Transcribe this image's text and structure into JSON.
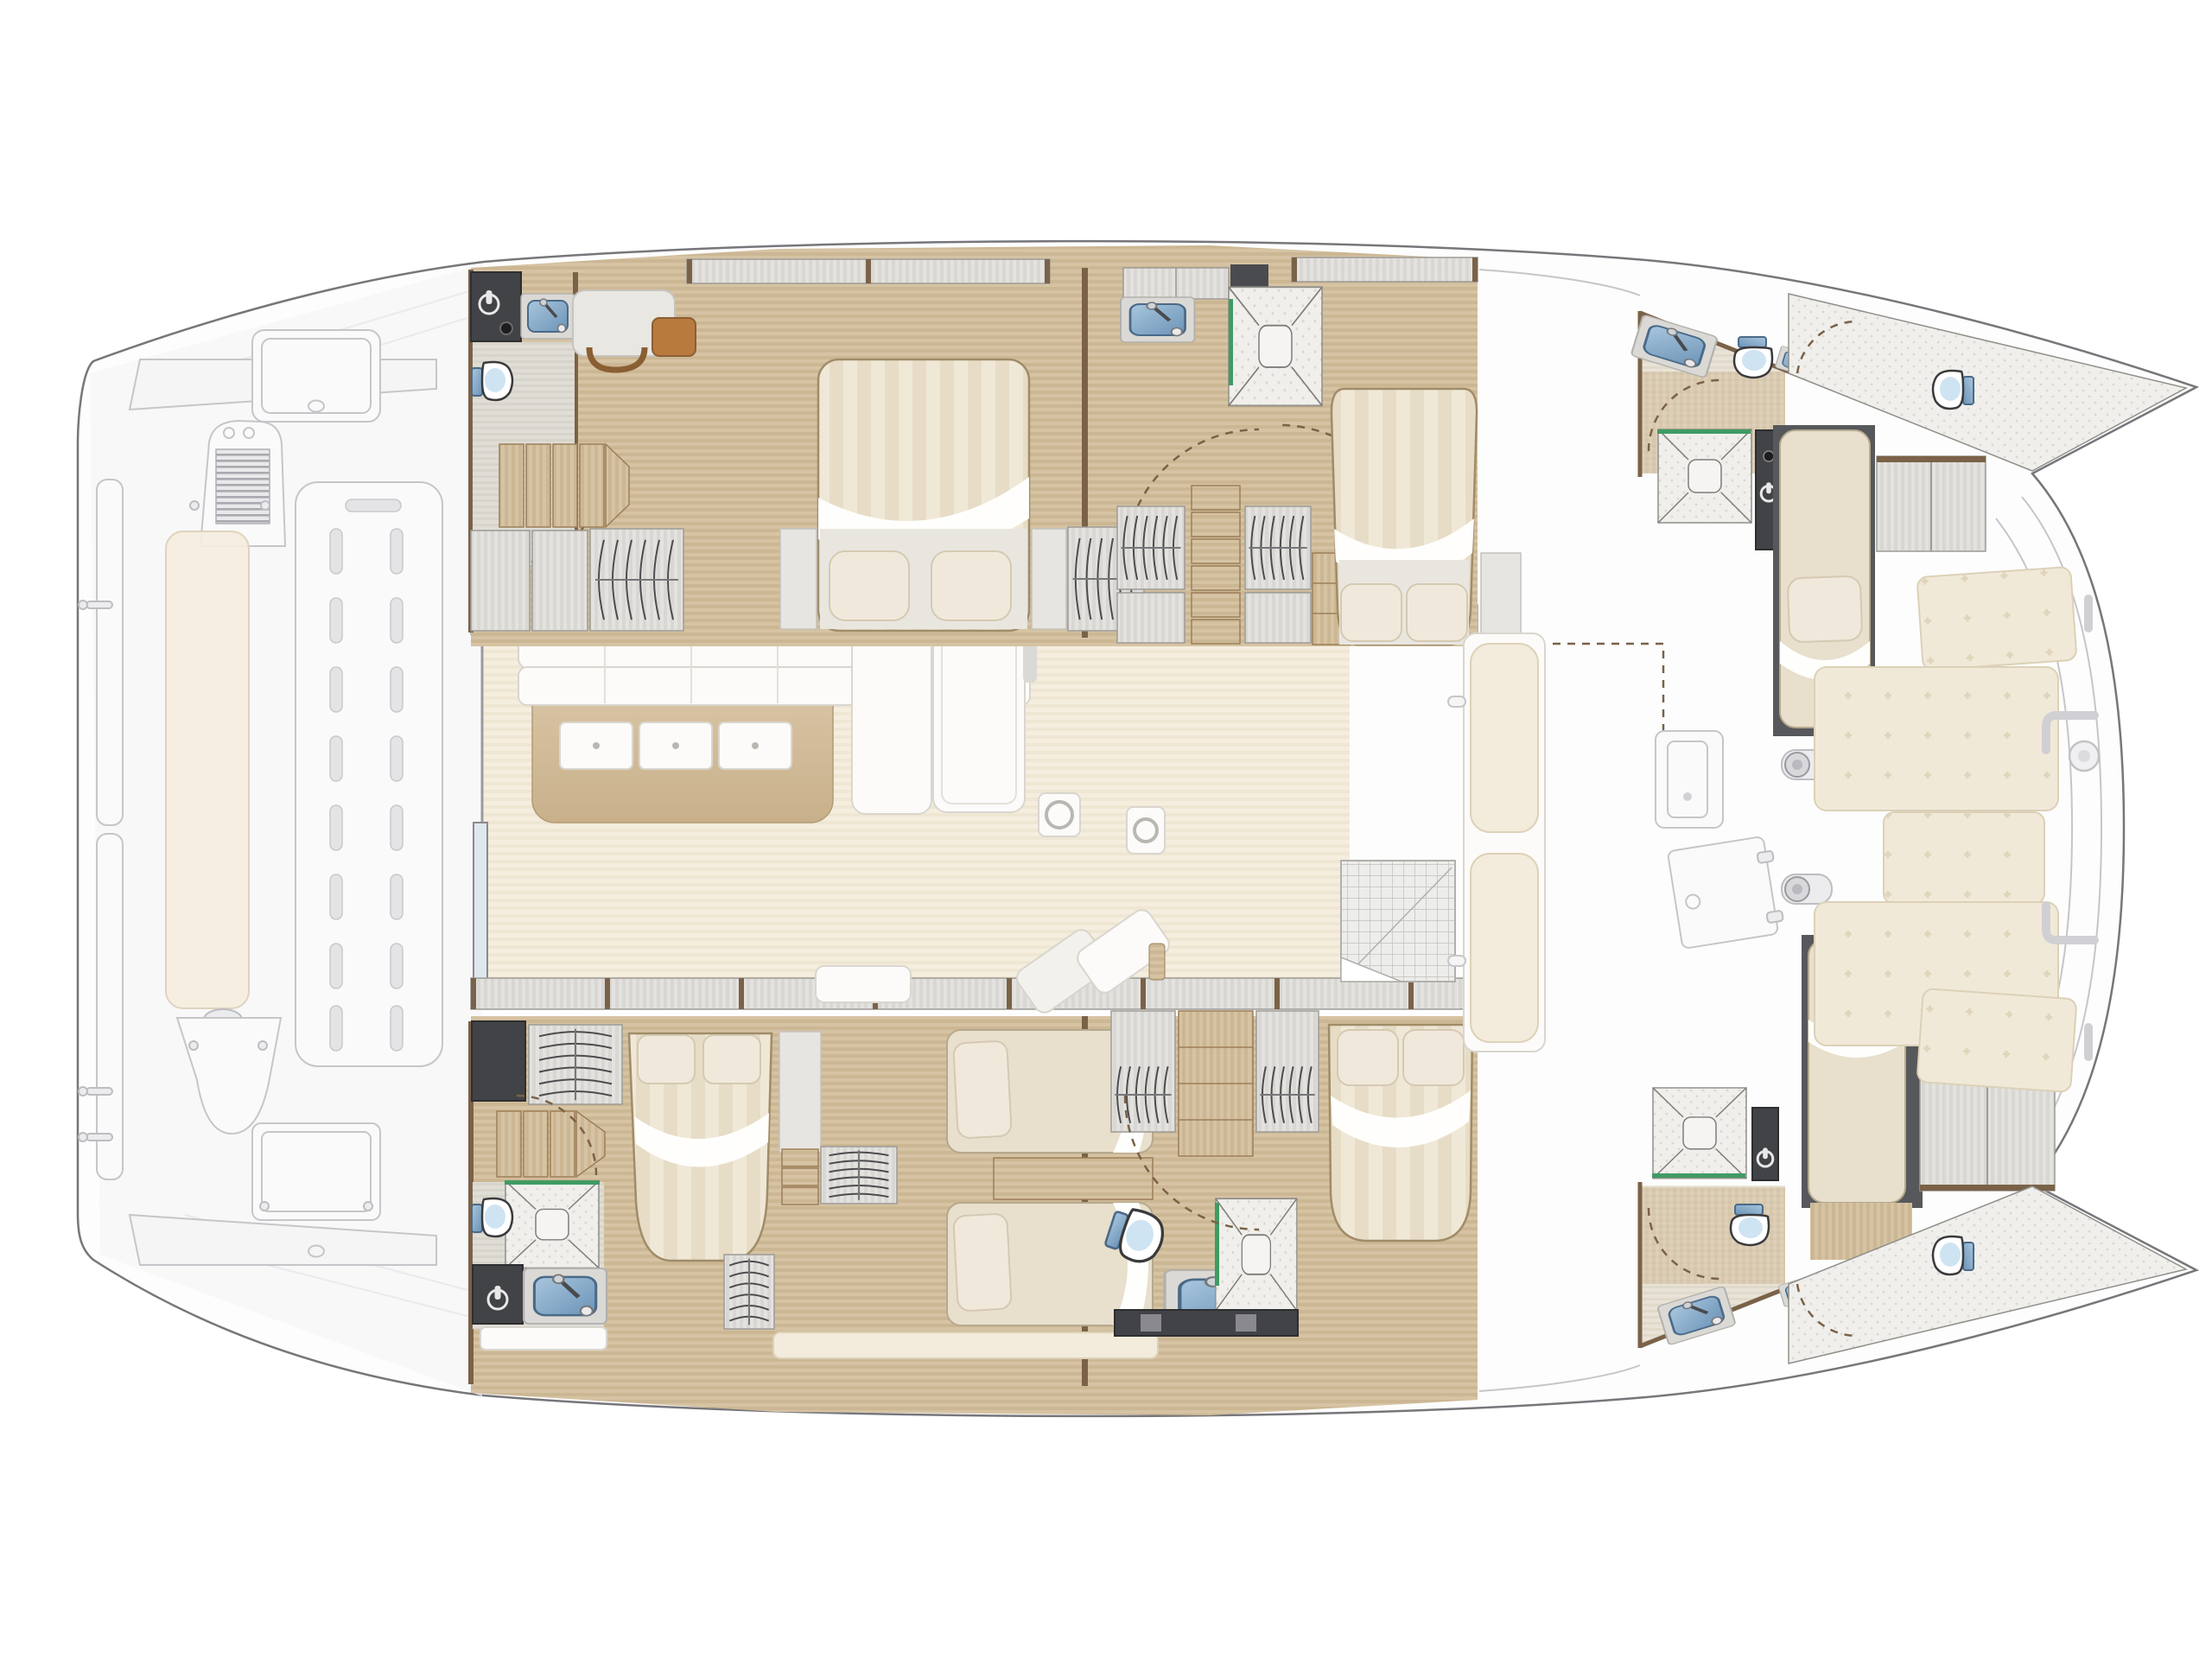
{
  "vessel": {
    "type": "sailing-catamaran",
    "view": "interior-deck-plan-top-view",
    "orientation": {
      "bow": "right",
      "stern": "left"
    }
  },
  "palette": {
    "hull-line": "#76767b",
    "ghost-line": "#c6c6ca",
    "ghost-fill": "#f5f5f6",
    "wall": "#7a6248",
    "wood-a": "#d6c3a3",
    "wood-b": "#ccb794",
    "woodpale-a": "#f5eedf",
    "woodpale-b": "#efe6d3",
    "wgray-a": "#e3e2df",
    "wgray-b": "#d8d7d3",
    "mattress-a": "#e7dcc6",
    "mattress-b": "#f0e8d7",
    "cushion": "#f3ebdb",
    "locker": "#424346",
    "sink-a": "#a9c6de",
    "sink-b": "#6b93b6",
    "glass": "#3f9b63",
    "speckle": "#f0efec",
    "island-a": "#dcc8a9",
    "island-b": "#c8b08a"
  },
  "areas": {
    "aft_deck": [
      "transom-benches",
      "grill-console",
      "cockpit-bench",
      "lounge-panel",
      "deck-hatch-forward",
      "deck-hatch-aft",
      "cleats",
      "helm-seat"
    ],
    "salon": [
      "galley-island",
      "island-drawers-x3",
      "bench-sofa",
      "sofa-corner-arm",
      "dining-table",
      "deck-ring-hatch",
      "deck-ring-hatch-2",
      "small-bench",
      "chaise-lounge",
      "sliding-door",
      "entry-mat"
    ],
    "port_hull": {
      "aft_cabin": [
        "double-berth",
        "pillows-x2",
        "wardrobe",
        "desk",
        "chair",
        "steps",
        "head-wc",
        "head-basin",
        "wet-locker"
      ],
      "mid_cabin": [
        "double-berth",
        "pillows-x2",
        "wardrobes-x2",
        "steps",
        "basin",
        "shower"
      ],
      "fwd_cabin": [
        "single-berth",
        "pillow",
        "wardrobe",
        "shower",
        "wet-locker",
        "head-wc",
        "head-basin"
      ],
      "forepeak": [
        "wc"
      ]
    },
    "starboard_hull": {
      "aft_cabin": [
        "double-berth",
        "single-berths-x2",
        "pillows",
        "wardrobes",
        "steps",
        "shower",
        "head-wc",
        "head-basin",
        "wet-locker"
      ],
      "mid_cabin": [
        "double-berth",
        "pillows-x2",
        "wardrobes-x2",
        "shelves",
        "head-wc",
        "head-basin",
        "shower"
      ],
      "fwd_cabin": [
        "single-berth",
        "pillow",
        "wardrobe",
        "shower",
        "wet-locker",
        "head-wc",
        "head-basin"
      ],
      "forepeak": [
        "wc"
      ]
    },
    "fore_deck": [
      "forward-bench",
      "bench-cushions-x2",
      "forward-door",
      "deck-cabinet",
      "winches-x2",
      "sunpads-x5",
      "grab-rails",
      "table-base",
      "threshold-mat"
    ]
  },
  "counts": {
    "cabins": 6,
    "berths_double": 4,
    "berths_single": 4,
    "heads": 6,
    "showers": 5
  }
}
